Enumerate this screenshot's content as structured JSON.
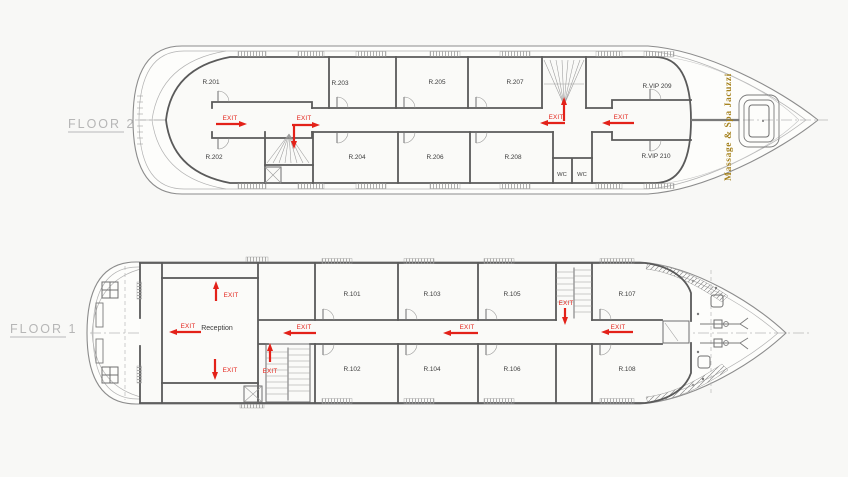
{
  "colors": {
    "background": "#f8f8f6",
    "walls": "#5a5a5a",
    "hull": "#8c8c8c",
    "exit_red": "#e32119",
    "spa_gold": "#a6831f",
    "room_label": "#3b3b3b",
    "floor_label": "#b6b6b6"
  },
  "floor2": {
    "label": "FLOOR 2",
    "spa_label": "Massage & Spa Jacuzzi",
    "rooms": {
      "r201": "R.201",
      "r202": "R.202",
      "r203": "R.203",
      "r204": "R.204",
      "r205": "R.205",
      "r206": "R.206",
      "r207": "R.207",
      "r208": "R.208",
      "rvip209": "R.VIP 209",
      "rvip210": "R.VIP 210"
    },
    "wc": {
      "wc1": "WC",
      "wc2": "WC"
    },
    "exits": [
      {
        "label": "EXIT",
        "direction": "right"
      },
      {
        "label": "EXIT",
        "direction": "right-down"
      },
      {
        "label": "EXIT",
        "direction": "up-left"
      },
      {
        "label": "EXIT",
        "direction": "left"
      }
    ]
  },
  "floor1": {
    "label": "FLOOR 1",
    "reception_label": "Reception",
    "rooms": {
      "r101": "R.101",
      "r102": "R.102",
      "r103": "R.103",
      "r104": "R.104",
      "r105": "R.105",
      "r106": "R.106",
      "r107": "R.107",
      "r108": "R.108"
    },
    "exits": [
      {
        "label": "EXIT",
        "direction": "up"
      },
      {
        "label": "EXIT",
        "direction": "left"
      },
      {
        "label": "EXIT",
        "direction": "down"
      },
      {
        "label": "EXIT",
        "direction": "up"
      },
      {
        "label": "EXIT",
        "direction": "left"
      },
      {
        "label": "EXIT",
        "direction": "left"
      },
      {
        "label": "EXIT",
        "direction": "down"
      },
      {
        "label": "EXIT",
        "direction": "left"
      }
    ]
  }
}
